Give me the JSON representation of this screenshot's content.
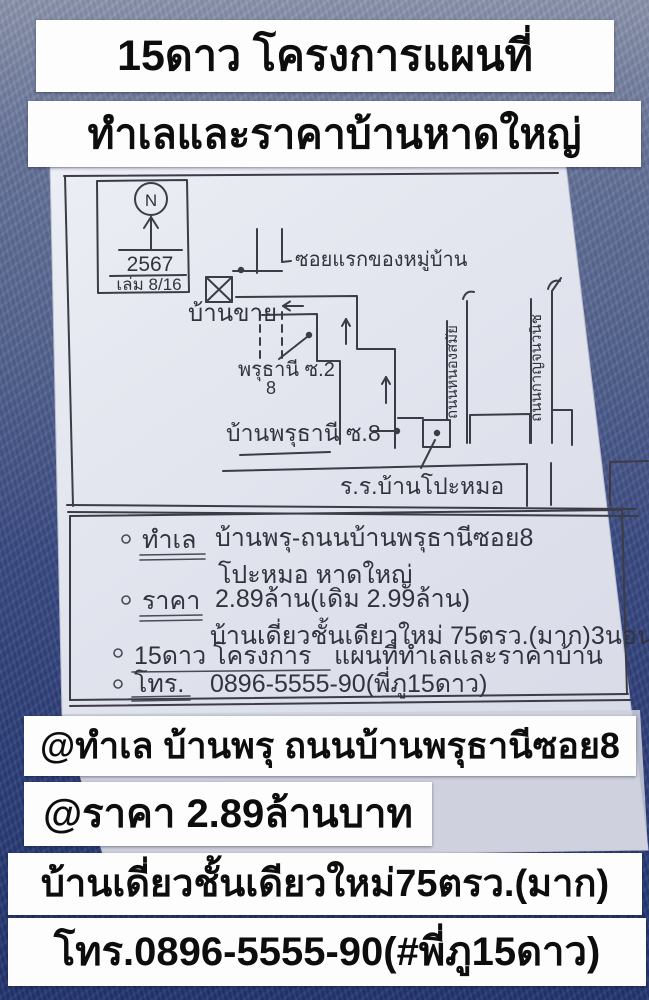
{
  "header": {
    "title_line1": "15ดาว โครงการแผนที่",
    "title_line2": "ทำเลและราคาบ้านหาดใหญ่"
  },
  "map": {
    "compass": {
      "north_label": "N",
      "year": "2567",
      "book_ref": "เล่ม 8/16"
    },
    "labels": {
      "first_soi": "ซอยแรกของหมู่บ้าน",
      "house_for_sale": "บ้านขาย",
      "phruthani_soi2": "พรุธานี ซ.2",
      "phruthani_soi2_number": "8",
      "ban_phruthani_soi8": "บ้านพรุธานี ซ.8",
      "road_left_vertical": "ถนนหนองสมัย",
      "road_right_vertical": "ถนนกาญจนวนิช",
      "school": "ร.ร.บ้านโปะหมอ"
    }
  },
  "notes": {
    "rows": [
      {
        "heading": "ทำเล",
        "text": "บ้านพรุ-ถนนบ้านพรุธานีซอย8"
      },
      {
        "heading": "",
        "text": "โปะหมอ หาดใหญ่"
      },
      {
        "heading": "ราคา",
        "text": "2.89ล้าน(เดิม 2.99ล้าน)"
      },
      {
        "heading": "",
        "text": "บ้านเดี่ยวชั้นเดียวใหม่ 75ตรว.(มาก)3นอน"
      },
      {
        "heading": "15ดาว โครงการ",
        "text": "แผนที่ทำเลและราคาบ้าน"
      },
      {
        "heading": "โทร.",
        "text": "0896-5555-90(พี่ภู15ดาว)"
      }
    ]
  },
  "footer": {
    "location_line": "@ทำเล บ้านพรุ ถนนบ้านพรุธานีซอย8",
    "price_line": "@ราคา 2.89ล้านบาท",
    "house_line": "บ้านเดี่ยวชั้นเดียวใหม่75ตรว.(มาก)",
    "phone_line": "โทร.0896-5555-90(#พี่ภู15ดาว)"
  },
  "colors": {
    "background_blue": "#31427b",
    "paper": "#e3e5ee",
    "banner_background": "#fdfdfd",
    "ink": "#3c3c47",
    "text_black": "#0d0d0d"
  }
}
